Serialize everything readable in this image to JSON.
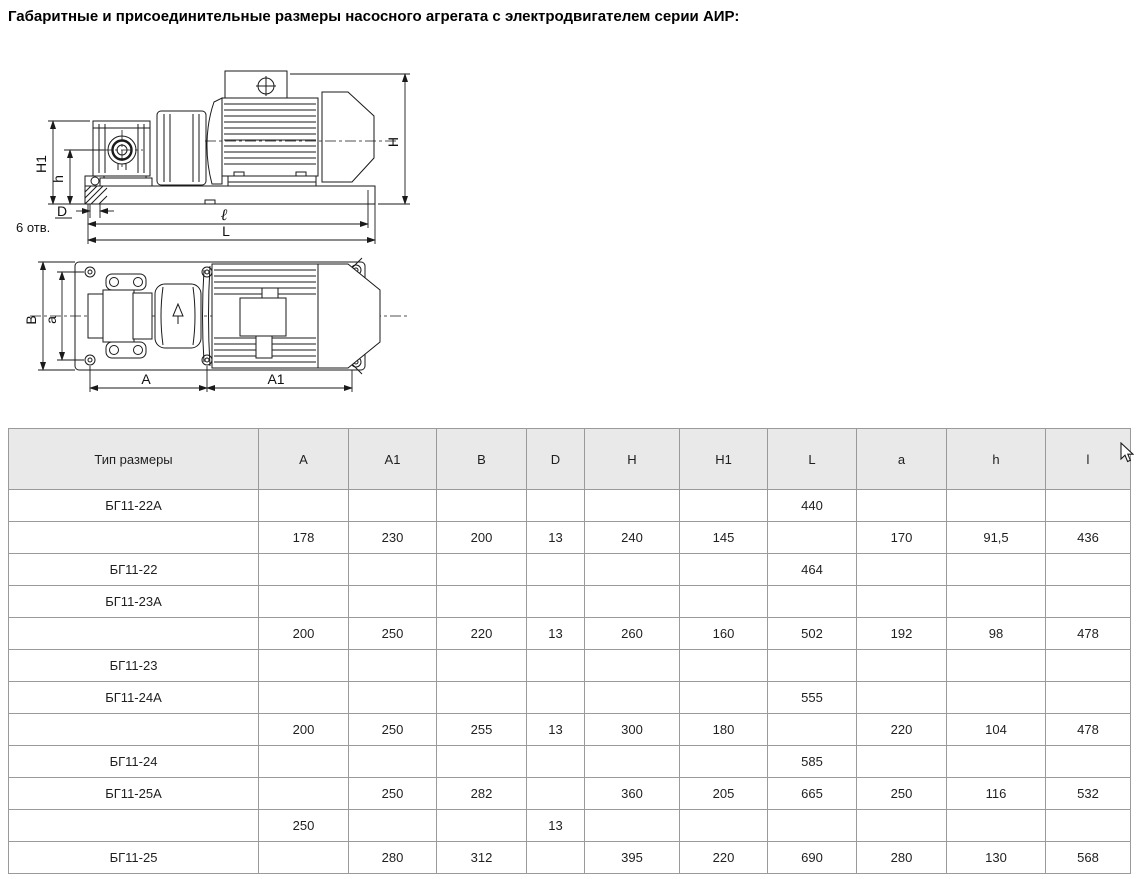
{
  "page": {
    "title": "Габаритные и присоединительные размеры насосного агрегата с электродвигателем серии АИР:"
  },
  "colors": {
    "header_bg": "#e9e9e9",
    "table_border": "#9a9a9a",
    "text": "#1e1e1e",
    "drawing_stroke": "#1a1a1a",
    "page_bg": "#ffffff"
  },
  "drawing": {
    "side_view": {
      "labels": {
        "height_total": "H",
        "height_axis": "H1",
        "height_foot": "h",
        "hole_diameter": "D",
        "holes_note": "6 отв.",
        "length_mount": "ℓ",
        "length_total": "L"
      }
    },
    "top_view": {
      "labels": {
        "width_total": "B",
        "width_holes": "a",
        "length_pump_side": "A",
        "length_motor_side": "A1"
      }
    }
  },
  "table": {
    "columns": [
      "Тип размеры",
      "A",
      "A1",
      "B",
      "D",
      "H",
      "H1",
      "L",
      "a",
      "h",
      "l"
    ],
    "rows": [
      [
        "БГ11-22А",
        "",
        "",
        "",
        "",
        "",
        "",
        "440",
        "",
        "",
        ""
      ],
      [
        "",
        "178",
        "230",
        "200",
        "13",
        "240",
        "145",
        "",
        "170",
        "91,5",
        "436"
      ],
      [
        "БГ11-22",
        "",
        "",
        "",
        "",
        "",
        "",
        "464",
        "",
        "",
        ""
      ],
      [
        "БГ11-23А",
        "",
        "",
        "",
        "",
        "",
        "",
        "",
        "",
        "",
        ""
      ],
      [
        "",
        "200",
        "250",
        "220",
        "13",
        "260",
        "160",
        "502",
        "192",
        "98",
        "478"
      ],
      [
        "БГ11-23",
        "",
        "",
        "",
        "",
        "",
        "",
        "",
        "",
        "",
        ""
      ],
      [
        "БГ11-24А",
        "",
        "",
        "",
        "",
        "",
        "",
        "555",
        "",
        "",
        ""
      ],
      [
        "",
        "200",
        "250",
        "255",
        "13",
        "300",
        "180",
        "",
        "220",
        "104",
        "478"
      ],
      [
        "БГ11-24",
        "",
        "",
        "",
        "",
        "",
        "",
        "585",
        "",
        "",
        ""
      ],
      [
        "БГ11-25А",
        "",
        "250",
        "282",
        "",
        "360",
        "205",
        "665",
        "250",
        "116",
        "532"
      ],
      [
        "",
        "250",
        "",
        "",
        "13",
        "",
        "",
        "",
        "",
        "",
        ""
      ],
      [
        "БГ11-25",
        "",
        "280",
        "312",
        "",
        "395",
        "220",
        "690",
        "280",
        "130",
        "568"
      ]
    ]
  }
}
